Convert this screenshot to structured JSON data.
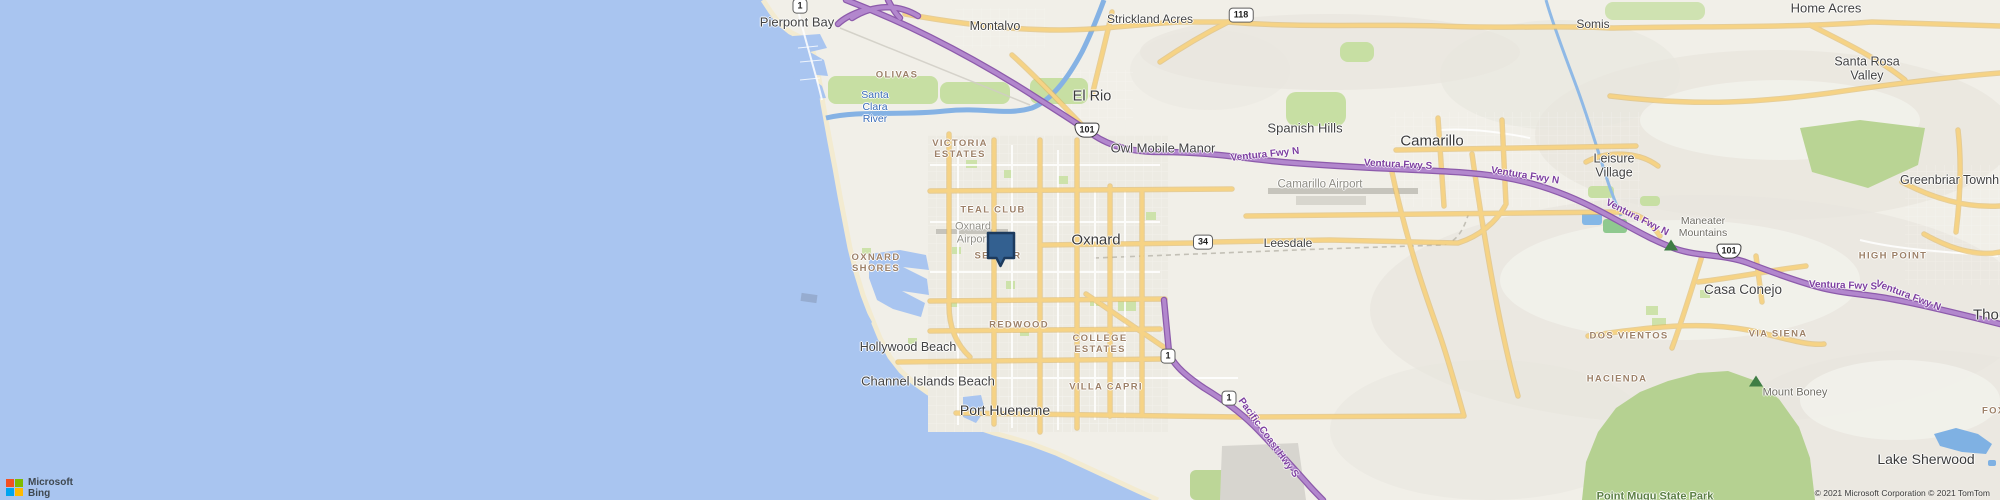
{
  "app": {
    "name": "Bing Maps map view"
  },
  "attribution": {
    "microsoft": "Microsoft",
    "bing": "Bing",
    "copyright": "© 2021 Microsoft Corporation © 2021 TomTom"
  },
  "marker": {
    "location": "Oxnard",
    "fill": "#336090",
    "border": "#1d3b5e"
  },
  "colors": {
    "ocean": "#a9c5f0",
    "land": "#f1efe8",
    "park_green": "#b5d191",
    "road_yellow": "#f6d385",
    "freeway_purple": "#a674c4",
    "hood_label": "#9d8168",
    "ms_red": "#f25022",
    "ms_green": "#7fba00",
    "ms_blue": "#00a4ef",
    "ms_yellow": "#ffb900"
  },
  "map": {
    "labels": [
      {
        "name": "shield-ca1-north",
        "kind": "shield",
        "text": "1",
        "x": 800,
        "y": 6
      },
      {
        "name": "shield-us101-elrio",
        "kind": "shield-us",
        "text": "101",
        "x": 1087,
        "y": 130
      },
      {
        "name": "shield-ca118",
        "kind": "shield",
        "text": "118",
        "x": 1241,
        "y": 15
      },
      {
        "name": "shield-ca34",
        "kind": "shield",
        "text": "34",
        "x": 1203,
        "y": 242
      },
      {
        "name": "shield-us101-conejo",
        "kind": "shield-us",
        "text": "101",
        "x": 1729,
        "y": 251
      },
      {
        "name": "shield-ca1-mid",
        "kind": "shield",
        "text": "1",
        "x": 1168,
        "y": 356
      },
      {
        "name": "shield-ca1-south",
        "kind": "shield",
        "text": "1",
        "x": 1229,
        "y": 398
      },
      {
        "name": "pierpont-bay-label",
        "kind": "town",
        "text": "Pierpont Bay",
        "x": 797,
        "y": 23,
        "fs": 13
      },
      {
        "name": "montalvo-label",
        "kind": "town",
        "text": "Montalvo",
        "x": 995,
        "y": 26
      },
      {
        "name": "strickland-acres-label",
        "kind": "town",
        "text": "Strickland Acres",
        "x": 1150,
        "y": 20,
        "fs": 12
      },
      {
        "name": "somis-label",
        "kind": "town",
        "text": "Somis",
        "x": 1593,
        "y": 25,
        "fs": 12
      },
      {
        "name": "home-acres-label",
        "kind": "town",
        "text": "Home Acres",
        "x": 1826,
        "y": 9,
        "fs": 13
      },
      {
        "name": "santa-rosa-valley-label",
        "kind": "town",
        "text": "Santa Rosa\nValley",
        "x": 1867,
        "y": 69
      },
      {
        "name": "el-rio-label",
        "kind": "city",
        "text": "El Rio",
        "x": 1092,
        "y": 97,
        "fs": 14.5
      },
      {
        "name": "spanish-hills-label",
        "kind": "town",
        "text": "Spanish Hills",
        "x": 1305,
        "y": 129,
        "fs": 13
      },
      {
        "name": "owl-mobile-manor-label",
        "kind": "town",
        "text": "Owl Mobile Manor",
        "x": 1163,
        "y": 149,
        "fs": 13
      },
      {
        "name": "camarillo-label",
        "kind": "city",
        "text": "Camarillo",
        "x": 1432,
        "y": 141
      },
      {
        "name": "leisure-village-label",
        "kind": "town",
        "text": "Leisure\nVillage",
        "x": 1614,
        "y": 166
      },
      {
        "name": "greenbriar-town-label",
        "kind": "town",
        "text": "Greenbriar Townh",
        "x": 1900,
        "y": 180,
        "align": "left"
      },
      {
        "name": "oxnard-label",
        "kind": "city",
        "text": "Oxnard",
        "x": 1096,
        "y": 240
      },
      {
        "name": "leesdale-label",
        "kind": "town",
        "text": "Leesdale",
        "x": 1288,
        "y": 244,
        "fs": 12
      },
      {
        "name": "casa-conejo-label",
        "kind": "town",
        "text": "Casa Conejo",
        "x": 1743,
        "y": 290,
        "fs": 13.5
      },
      {
        "name": "thousand-oaks-label-cutoff",
        "kind": "city",
        "text": "Thou",
        "x": 1973,
        "y": 315,
        "align": "left"
      },
      {
        "name": "hollywood-beach-label",
        "kind": "town",
        "text": "Hollywood Beach",
        "x": 908,
        "y": 347
      },
      {
        "name": "channel-islands-beach-label",
        "kind": "town",
        "text": "Channel Islands Beach",
        "x": 928,
        "y": 382,
        "fs": 13
      },
      {
        "name": "port-hueneme-label",
        "kind": "city",
        "text": "Port Hueneme",
        "x": 1005,
        "y": 410,
        "fs": 14
      },
      {
        "name": "lake-sherwood-label",
        "kind": "city",
        "text": "Lake Sherwood",
        "x": 1926,
        "y": 459,
        "fs": 14
      },
      {
        "name": "olivas-label",
        "kind": "hood",
        "text": "OLIVAS",
        "x": 897,
        "y": 76
      },
      {
        "name": "victoria-estates-label",
        "kind": "hood",
        "text": "VICTORIA\nESTATES",
        "x": 960,
        "y": 150
      },
      {
        "name": "teal-club-label",
        "kind": "hood",
        "text": "TEAL CLUB",
        "x": 993,
        "y": 211
      },
      {
        "name": "sea-air-label",
        "kind": "hood",
        "text": "SEA AIR",
        "x": 998,
        "y": 257
      },
      {
        "name": "oxnard-shores-label",
        "kind": "hood",
        "text": "OXNARD\nSHORES",
        "x": 876,
        "y": 264
      },
      {
        "name": "redwood-label",
        "kind": "hood",
        "text": "REDWOOD",
        "x": 1019,
        "y": 326
      },
      {
        "name": "college-estates-label",
        "kind": "hood",
        "text": "COLLEGE\nESTATES",
        "x": 1100,
        "y": 345
      },
      {
        "name": "villa-capri-label",
        "kind": "hood",
        "text": "VILLA CAPRI",
        "x": 1106,
        "y": 388
      },
      {
        "name": "high-point-label",
        "kind": "hood",
        "text": "HIGH POINT",
        "x": 1893,
        "y": 257
      },
      {
        "name": "dos-vientos-label",
        "kind": "hood",
        "text": "DOS VIENTOS",
        "x": 1629,
        "y": 337
      },
      {
        "name": "via-siena-label",
        "kind": "hood",
        "text": "VIA SIENA",
        "x": 1778,
        "y": 335
      },
      {
        "name": "hacienda-label",
        "kind": "hood",
        "text": "HACIENDA",
        "x": 1617,
        "y": 380
      },
      {
        "name": "foxmoor-label-cutoff",
        "kind": "hood",
        "text": "FOXMO",
        "x": 1982,
        "y": 412,
        "align": "left"
      },
      {
        "name": "santa-clara-river-label",
        "kind": "water-lbl",
        "text": "Santa\nClara\nRiver",
        "x": 875,
        "y": 107
      },
      {
        "name": "oxnard-airport-label",
        "kind": "gray-lbl",
        "text": "Oxnard\nAirport",
        "x": 973,
        "y": 233
      },
      {
        "name": "camarillo-airport-label",
        "kind": "gray-lbl",
        "text": "Camarillo Airport",
        "x": 1320,
        "y": 185,
        "fs": 11.5
      },
      {
        "name": "maneater-mountains-label",
        "kind": "mtn",
        "text": "Maneater\nMountains",
        "x": 1703,
        "y": 227
      },
      {
        "name": "mount-boney-label",
        "kind": "mtn",
        "text": "Mount Boney",
        "x": 1795,
        "y": 393,
        "fs": 11
      },
      {
        "name": "point-mugu-state-park-label",
        "kind": "park-lbl",
        "text": "Point Mugu State Park",
        "x": 1655,
        "y": 497
      },
      {
        "name": "ventura-fwy-n-label-1",
        "kind": "fwy",
        "text": "Ventura Fwy N",
        "x": 1265,
        "y": 155,
        "rot": -6
      },
      {
        "name": "ventura-fwy-s-label-1",
        "kind": "fwy",
        "text": "Ventura Fwy S",
        "x": 1398,
        "y": 165,
        "rot": 3
      },
      {
        "name": "ventura-fwy-n-label-2",
        "kind": "fwy",
        "text": "Ventura Fwy N",
        "x": 1525,
        "y": 176,
        "rot": 9
      },
      {
        "name": "ventura-fwy-n-label-3",
        "kind": "fwy",
        "text": "Ventura Fwy N",
        "x": 1637,
        "y": 218,
        "rot": 27
      },
      {
        "name": "ventura-fwy-s-label-2",
        "kind": "fwy",
        "text": "Ventura Fwy S",
        "x": 1843,
        "y": 286,
        "rot": 2
      },
      {
        "name": "ventura-fwy-n-label-4",
        "kind": "fwy",
        "text": "Ventura Fwy N",
        "x": 1908,
        "y": 296,
        "rot": 21
      },
      {
        "name": "pacific-coast-hwy-s-label",
        "kind": "fwy",
        "text": "Pacific Coast Hwy S",
        "x": 1268,
        "y": 438,
        "rot": 54
      },
      {
        "name": "peak-icon-maneater",
        "kind": "peak",
        "text": "",
        "x": 1671,
        "y": 245
      },
      {
        "name": "peak-icon-mount-boney",
        "kind": "peak",
        "text": "",
        "x": 1756,
        "y": 381
      }
    ]
  }
}
